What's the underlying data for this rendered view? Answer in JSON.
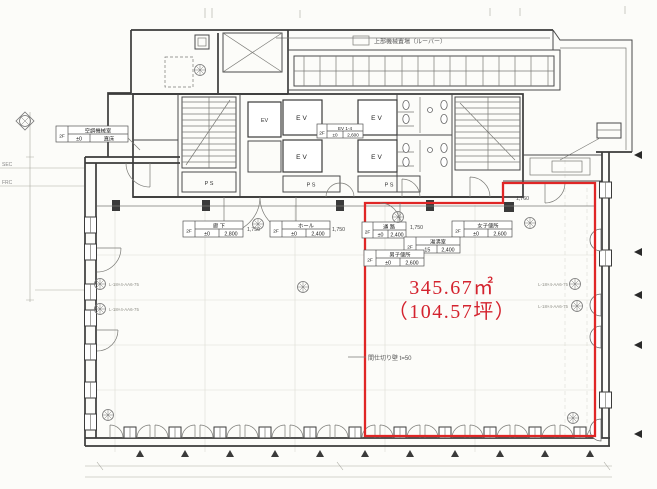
{
  "drawing": {
    "area": {
      "m2": "345.67㎡",
      "tsubo": "（104.57坪）"
    },
    "core": {
      "ev": "EV",
      "ps": "P S",
      "ev_hall": {
        "floor": "2F",
        "name": "EV 1-4",
        "level": "±0",
        "height": "2,600"
      }
    },
    "tags": {
      "machine_room": {
        "floor": "2F",
        "name": "空調機械室",
        "level": "±0",
        "finish": "直床"
      },
      "corridor": {
        "floor": "2F",
        "name": "廊 下",
        "level": "±0",
        "height": "2,800"
      },
      "hall": {
        "floor": "2F",
        "name": "ホール",
        "level": "±0",
        "height": "2,400"
      },
      "passage": {
        "floor": "2F",
        "name": "通 路",
        "level": "±0",
        "height": "2,400"
      },
      "women_toilet": {
        "floor": "2F",
        "name": "女子便所",
        "level": "±0",
        "height": "2,600"
      },
      "kitchenette": {
        "floor": "2F",
        "name": "湯沸室",
        "level": "-15",
        "height": "2,400"
      },
      "men_toilet": {
        "floor": "2F",
        "name": "男子便所",
        "level": "±0",
        "height": "2,600"
      }
    },
    "dims": {
      "d1": "1,750",
      "d2": "1,750",
      "d3": "1,750",
      "d4": "1,760"
    },
    "notes": {
      "louver": "上部機械置場（ルーバー）",
      "partition": "間仕切り壁 t=50",
      "sec": "SEC",
      "frc": "FRC",
      "anno": "L-18×4-AA6-75"
    }
  }
}
